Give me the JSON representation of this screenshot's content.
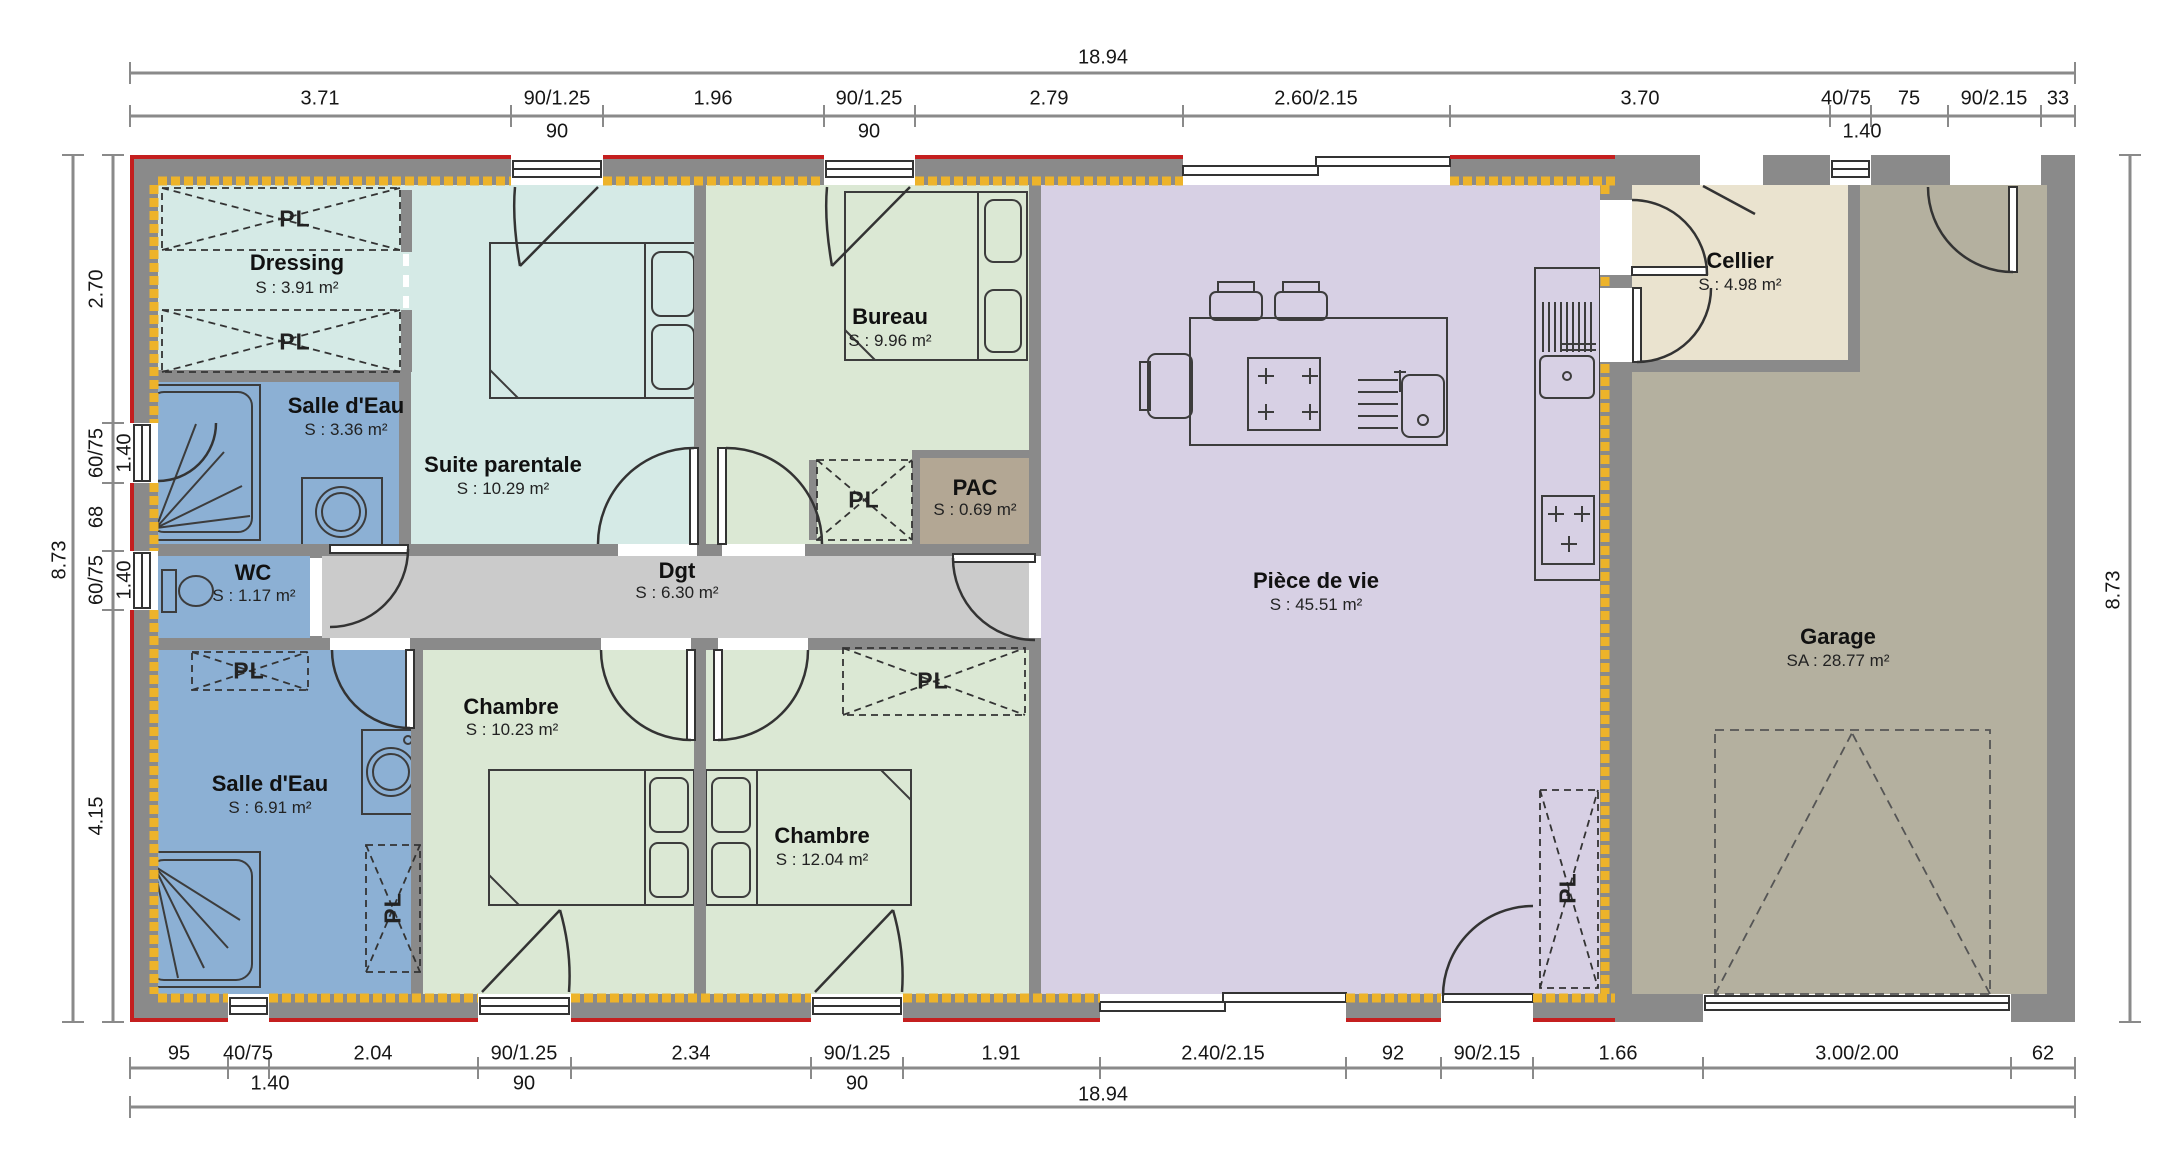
{
  "rooms": [
    {
      "name": "Dressing",
      "area": "S : 3.91 m²"
    },
    {
      "name": "Salle d'Eau",
      "area": "S : 3.36 m²"
    },
    {
      "name": "Suite parentale",
      "area": "S : 10.29 m²"
    },
    {
      "name": "Bureau",
      "area": "S : 9.96 m²"
    },
    {
      "name": "PAC",
      "area": "S : 0.69 m²"
    },
    {
      "name": "WC",
      "area": "S : 1.17 m²"
    },
    {
      "name": "Dgt",
      "area": "S : 6.30 m²"
    },
    {
      "name": "Salle d'Eau",
      "area": "S : 6.91 m²"
    },
    {
      "name": "Chambre",
      "area": "S : 10.23 m²"
    },
    {
      "name": "Chambre",
      "area": "S : 12.04 m²"
    },
    {
      "name": "Pièce de vie",
      "area": "S : 45.51 m²"
    },
    {
      "name": "Cellier",
      "area": "S : 4.98 m²"
    },
    {
      "name": "Garage",
      "area": "SA : 28.77 m²"
    }
  ],
  "closet": {
    "label": "PL"
  },
  "dims": {
    "top": {
      "overall": "18.94",
      "labels": [
        "3.71",
        "90/1.25",
        "1.96",
        "90/1.25",
        "2.79",
        "2.60/2.15",
        "3.70",
        "40/75",
        "75",
        "90/2.15",
        "33"
      ],
      "subs": [
        "90",
        "90",
        "1.40"
      ]
    },
    "bottom": {
      "overall": "18.94",
      "labels": [
        "95",
        "40/75",
        "2.04",
        "90/1.25",
        "2.34",
        "90/1.25",
        "1.91",
        "2.40/2.15",
        "92",
        "90/2.15",
        "1.66",
        "3.00/2.00",
        "62"
      ],
      "subs": [
        "1.40",
        "90",
        "90"
      ]
    },
    "left": {
      "overall": "8.73",
      "labels": [
        "2.70",
        "60/75",
        "68",
        "60/75",
        "4.15"
      ],
      "subs": [
        "1.40",
        "1.40"
      ]
    },
    "right": {
      "overall": "8.73"
    }
  },
  "colors": {
    "wall": "#8a8a8a",
    "insulation": "#edb32a",
    "envelope_red": "#c41f1f",
    "suite_cyan": "#d5eae6",
    "bath_blue": "#8cb0d4",
    "bedroom_green": "#dbe8d4",
    "living_purple": "#d7d0e4",
    "cellier_beige": "#eae3cf",
    "garage_taupe": "#b4b09f",
    "corridor_grey": "#cbcbcb",
    "pac_taupe": "#b3a794",
    "dim_grey": "#8a8a8a"
  }
}
